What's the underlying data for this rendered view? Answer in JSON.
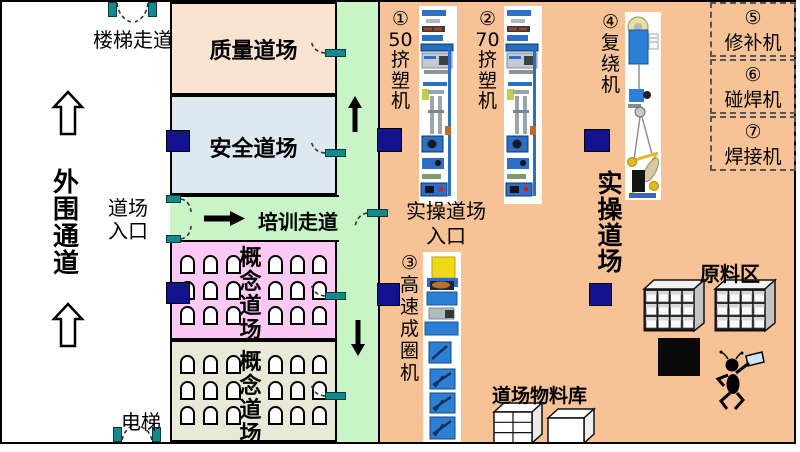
{
  "left_area": {
    "stairway_label": "楼梯走道",
    "perimeter_label": "外围通道",
    "entrance_label": "道场入口",
    "elevator_label": "电梯"
  },
  "rooms": {
    "quality": "质量道场",
    "safety": "安全道场",
    "training_corridor": "培训走道",
    "concept_a": "概念道场",
    "concept_b": "概念道场",
    "practical": "实操道场",
    "practical_entrance": "实操道场入口"
  },
  "machines": [
    {
      "num": "①",
      "name": "50挤塑机"
    },
    {
      "num": "②",
      "name": "70挤塑机"
    },
    {
      "num": "③",
      "name": "高速成圈机"
    },
    {
      "num": "④",
      "name": "复绕机"
    },
    {
      "num": "⑤",
      "name": "修补机"
    },
    {
      "num": "⑥",
      "name": "碰焊机"
    },
    {
      "num": "⑦",
      "name": "焊接机"
    }
  ],
  "storage": {
    "raw_material_label": "原料区",
    "material_store_label": "道场物料库"
  },
  "colors": {
    "practical_area": "#F6C296",
    "quality_room": "#FBE3D2",
    "safety_room": "#DCE9F0",
    "corridor_green": "#C9F4C6",
    "concept_pink": "#FBC9F3",
    "concept_olive": "#E8E9D7",
    "display_board_navy": "#13138F",
    "door_teal": "#158A8E"
  }
}
